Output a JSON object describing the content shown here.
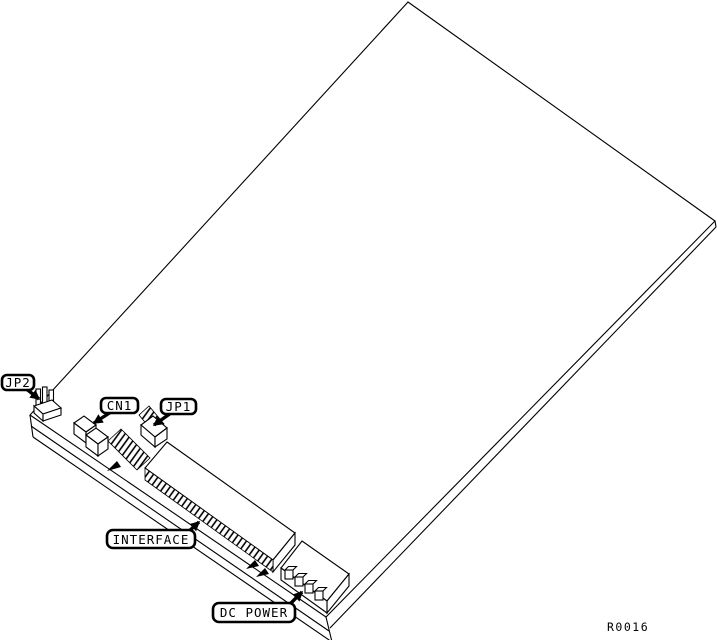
{
  "figure": {
    "type": "pcb-isometric-line-drawing",
    "description": "Isometric line drawing of a printed circuit board with callout labels pointing to jumpers and connectors",
    "background_color": "#ffffff",
    "line_color": "#000000",
    "reference_code": "R0016"
  },
  "callouts": {
    "jp2": {
      "label": "JP2"
    },
    "cn1": {
      "label": "CN1"
    },
    "jp1": {
      "label": "JP1"
    },
    "interface": {
      "label": "INTERFACE"
    },
    "dc_power": {
      "label": "DC POWER"
    }
  },
  "components": {
    "board": "printed circuit board (top face)",
    "jp2_header": "3-pin jumper header",
    "cn1_connector": "stepped two-section connector housing",
    "pin_strip": "hatched right-angle pin strip",
    "jp1_header": "jumper header on base block",
    "interface_connector": "long multi-pin interface header",
    "dc_power_connector": "4-pin DC power connector"
  }
}
